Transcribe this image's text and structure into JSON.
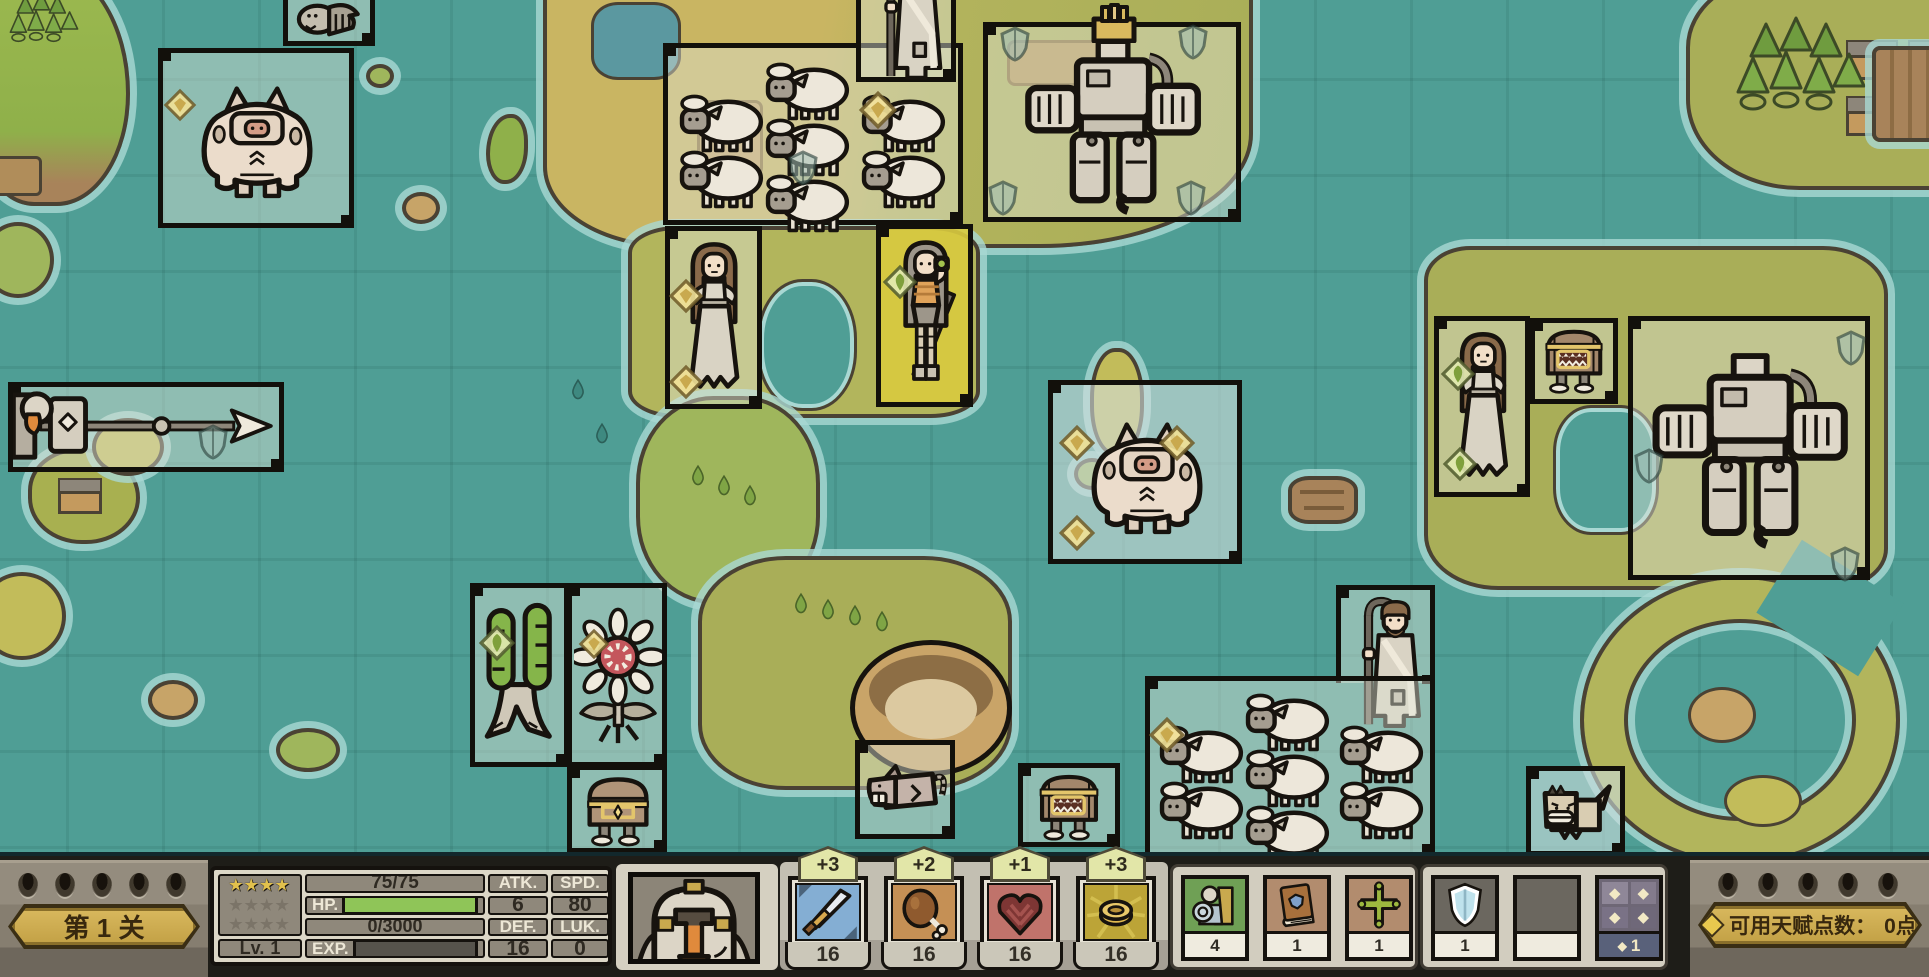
{
  "hud": {
    "level_banner": "第 1 关",
    "talent": {
      "label": "可用天赋点数：",
      "value": "0点"
    },
    "stats": {
      "stars_gold": "★★★★",
      "stars_grey_row1": "★★★★",
      "stars_grey_row2": "★★★★",
      "hp_label": "HP.",
      "hp_current": "75/75",
      "hp_percent": 100,
      "exp_label": "EXP.",
      "exp_current": "0/3000",
      "exp_percent": 0,
      "lv_label": "Lv.",
      "lv_value": "1",
      "atk_label": "ATK.",
      "atk_value": "6",
      "spd_label": "SPD.",
      "spd_value": "80",
      "def_label": "DEF.",
      "def_value": "16",
      "luk_label": "LUK.",
      "luk_value": "0"
    },
    "portrait": "knight-helmet-portrait",
    "weapons": [
      {
        "icon": "sword-icon",
        "bonus": "+3",
        "value": "16",
        "bg": "#84AED3"
      },
      {
        "icon": "meat-icon",
        "bonus": "+2",
        "value": "16",
        "bg": "#C59055"
      },
      {
        "icon": "heart-armor-icon",
        "bonus": "+1",
        "value": "16",
        "bg": "#C0736B"
      },
      {
        "icon": "coin-icon",
        "bonus": "+3",
        "value": "16",
        "bg": "#BCA437"
      }
    ],
    "items": [
      {
        "icon": "knight-figure-icon",
        "count": "4",
        "bg": "#6FA055"
      },
      {
        "icon": "book-icon",
        "count": "1",
        "bg": "#B28C6E"
      },
      {
        "icon": "cross-icon",
        "count": "1",
        "bg": "#B28C6E"
      },
      {
        "icon": "shield-item-icon",
        "count": "1",
        "bg": "#6B675F"
      },
      {
        "icon": "empty-slot",
        "count": "",
        "bg": "#6B675F"
      },
      {
        "icon": "talent-diamonds-icon",
        "count": "1",
        "count_prefix": "◆",
        "bg": "#6E6776"
      }
    ]
  },
  "map": {
    "units": [
      {
        "name": "bird-creature"
      },
      {
        "name": "pig-brute"
      },
      {
        "name": "sheep-flock",
        "count": 7
      },
      {
        "name": "monk"
      },
      {
        "name": "mech-golem-crowned"
      },
      {
        "name": "villager-woman"
      },
      {
        "name": "huntress"
      },
      {
        "name": "lance-knight"
      },
      {
        "name": "pig-brute"
      },
      {
        "name": "villager-woman"
      },
      {
        "name": "mimic-chest"
      },
      {
        "name": "mech-golem"
      },
      {
        "name": "twin-tree-creature"
      },
      {
        "name": "sunflower-creature"
      },
      {
        "name": "treasure-chest-walker"
      },
      {
        "name": "rat-creature"
      },
      {
        "name": "mimic-chest"
      },
      {
        "name": "sheep-flock",
        "count": 7
      },
      {
        "name": "shepherd"
      },
      {
        "name": "watchdog"
      }
    ]
  }
}
